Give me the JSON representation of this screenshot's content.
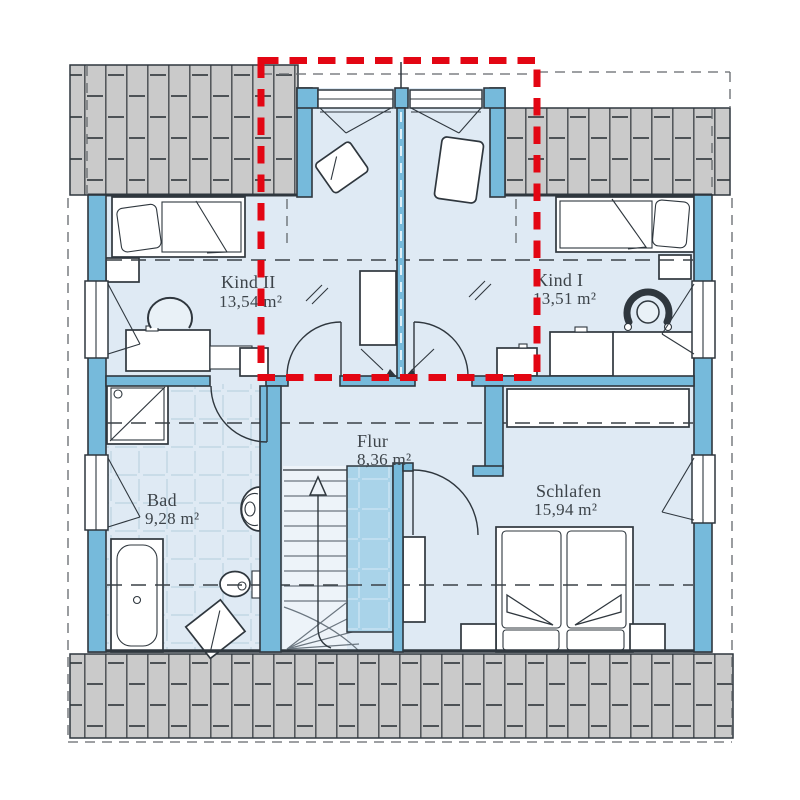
{
  "plan": {
    "type": "floor-plan",
    "rooms": [
      {
        "name": "Kind II",
        "area": "13,54 m²"
      },
      {
        "name": "Kind I",
        "area": "13,51 m²"
      },
      {
        "name": "Flur",
        "area": "8,36 m²"
      },
      {
        "name": "Bad",
        "area": "9,28 m²"
      },
      {
        "name": "Schlafen",
        "area": "15,94 m²"
      }
    ],
    "colors": {
      "highlight": "#e30613",
      "wall": "#76badb",
      "floor": "#dfeaf4",
      "roof_hatch": "#cacaca",
      "stairwell_void": "#a9d3e9",
      "outline": "#2f373e"
    }
  }
}
